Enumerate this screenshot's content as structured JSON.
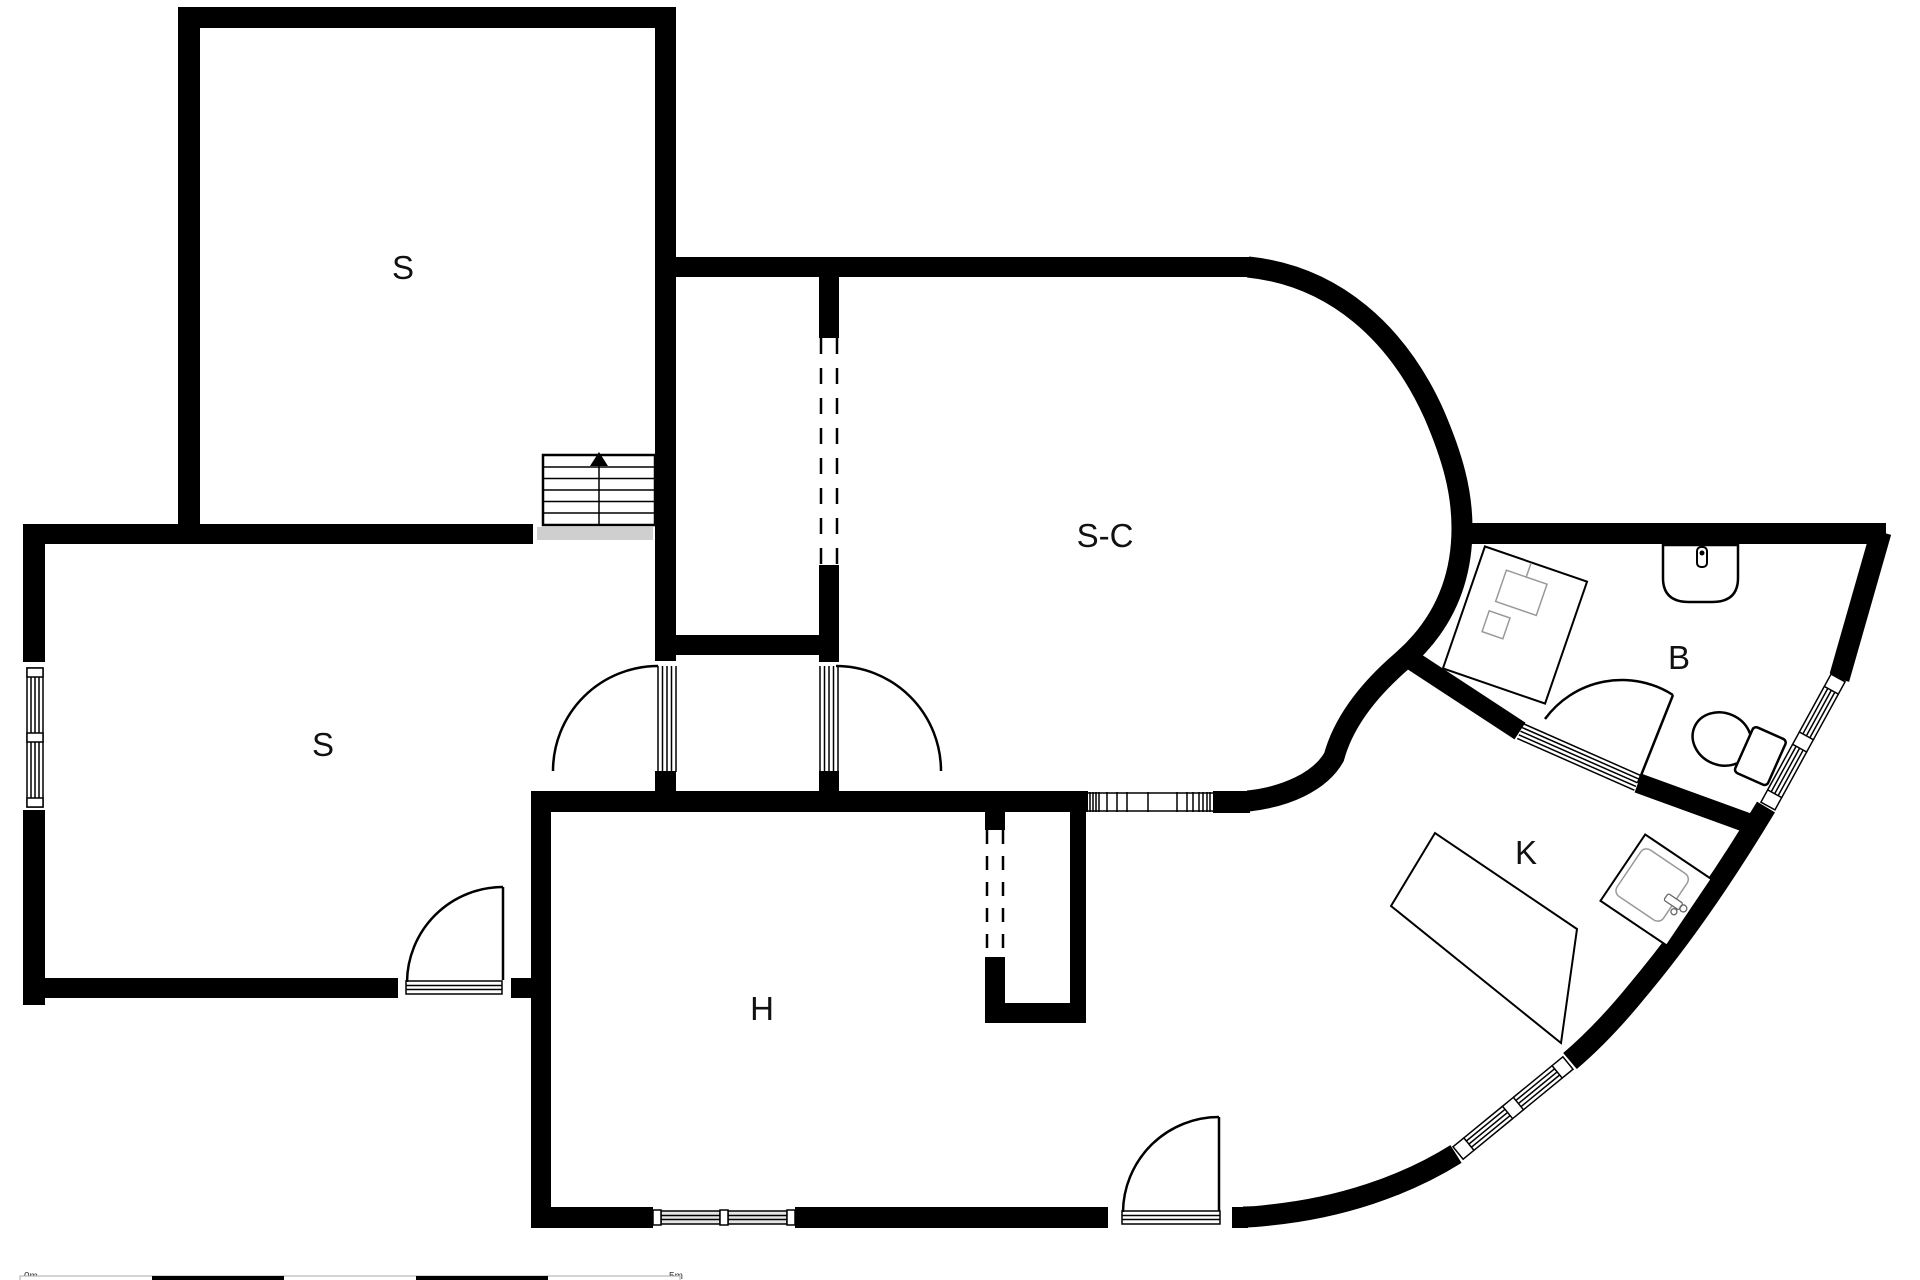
{
  "floor_plan": {
    "rooms": [
      {
        "name": "bedroom-upper",
        "label": "S"
      },
      {
        "name": "bedroom-lower",
        "label": "S"
      },
      {
        "name": "living-dining-room",
        "label": "S-C"
      },
      {
        "name": "bathroom",
        "label": "B"
      },
      {
        "name": "kitchen",
        "label": "K"
      },
      {
        "name": "hall",
        "label": "H"
      }
    ],
    "scale_bar": {
      "start": "0m",
      "end": "5m"
    },
    "colors": {
      "wall": "#000000",
      "background": "#ffffff",
      "label": "#111111",
      "stair_landing": "#cfcfcf"
    }
  }
}
